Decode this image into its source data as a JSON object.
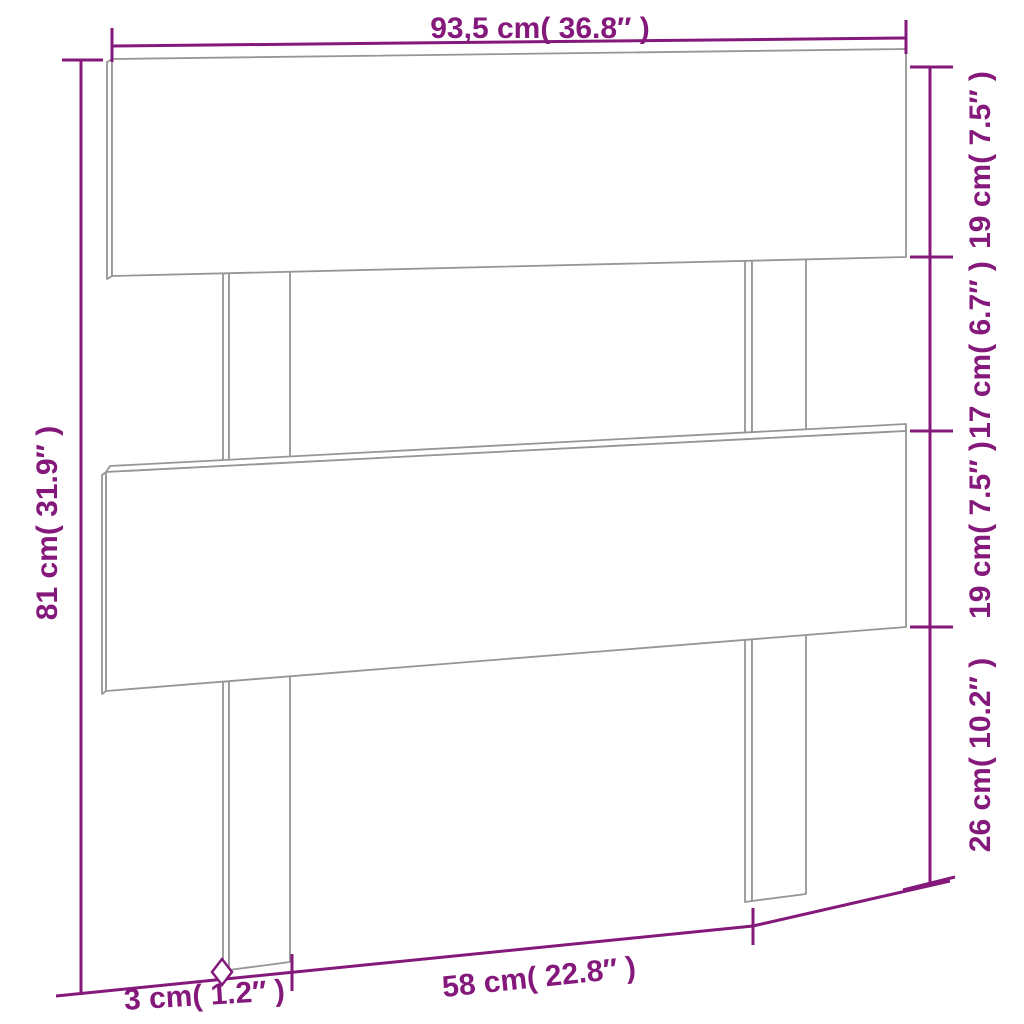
{
  "diagram": {
    "name": "headboard-dimension-drawing",
    "colors": {
      "dimension_accent": "#84197B",
      "wood_outline": "#969696",
      "background": "#FFFFFF"
    },
    "dimensions": {
      "top_width": "93,5 cm( 36.8″ )",
      "left_total_height": "81 cm( 31.9″ )",
      "right_segments": [
        {
          "label": "19 cm( 7.5″ )"
        },
        {
          "label": "17 cm( 6.7″ )"
        },
        {
          "label": "19 cm( 7.5″ )"
        },
        {
          "label": "26 cm( 10.2″ )"
        }
      ],
      "bottom_inner_span": "58 cm( 22.8″ )",
      "leg_thickness": "3 cm( 1.2″ )"
    }
  }
}
